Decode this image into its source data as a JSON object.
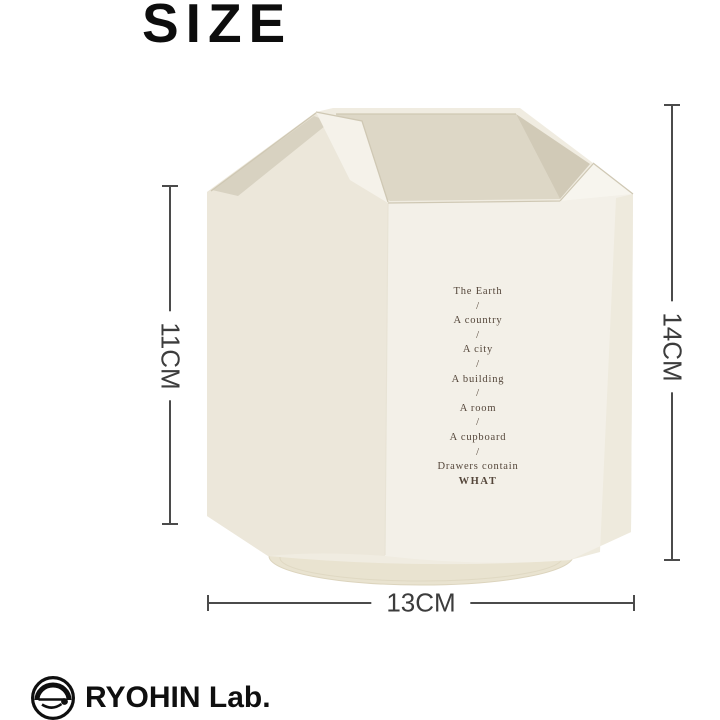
{
  "title": "SIZE",
  "dimensions": {
    "inner_height": "11CM",
    "total_height": "14CM",
    "width": "13CM"
  },
  "product": {
    "description": "cream hexagonal rotating pen holder",
    "poem_lines": [
      "The Earth",
      "/",
      "A country",
      "/",
      "A city",
      "/",
      "A building",
      "/",
      "A room",
      "/",
      "A cupboard",
      "/",
      "Drawers contain",
      "WHAT"
    ]
  },
  "brand": {
    "name": "RYOHIN Lab.",
    "icon": "ryohin-circle-logo"
  },
  "colors": {
    "background": "#ffffff",
    "title_text": "#0d0d0d",
    "dim_line": "#4b4b4b",
    "dim_text": "#3c3c3c",
    "poem_text": "#54463a",
    "brand_text": "#0f0f0f",
    "body_cream": "#f0ece1",
    "body_left": "#ece7da",
    "body_front": "#f3f0e8",
    "body_right": "#eeeadd",
    "bevel_bright": "#f7f5ee",
    "inner_back": "#ddd7c6",
    "inner_side": "#d1cab7",
    "pocket_shadow": "#d8d2c1",
    "divider_bright": "#f5f2ea",
    "base_disc": "#e9e3d0",
    "base_rim": "#dcd4bd",
    "edge_line": "#cfc8b4",
    "facet_line": "#e8e3d5"
  }
}
